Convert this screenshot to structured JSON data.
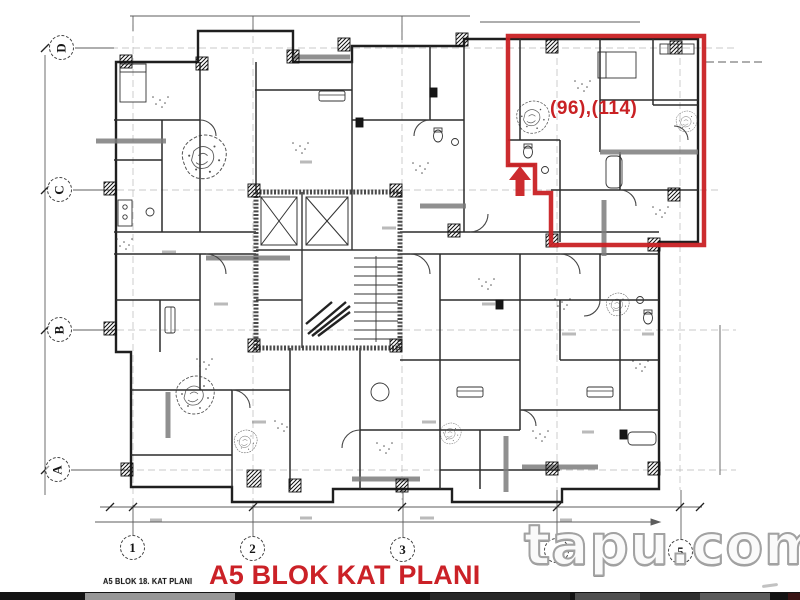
{
  "plan": {
    "annotation_label": "(96),(114)",
    "title": "A5 BLOK KAT PLANI",
    "subtitle": "A5 BLOK 18. KAT PLANI"
  },
  "grid": {
    "rows": [
      "D",
      "C",
      "B",
      "A"
    ],
    "cols": [
      "1",
      "2",
      "3",
      "4",
      "5"
    ]
  },
  "watermark": {
    "brand": "tapu.com"
  },
  "colors": {
    "highlight_red": "#c92124",
    "title_red": "#cb2127",
    "drawing_ink": "#2b2b2b",
    "watermark_gray": "#a2a2a2"
  }
}
